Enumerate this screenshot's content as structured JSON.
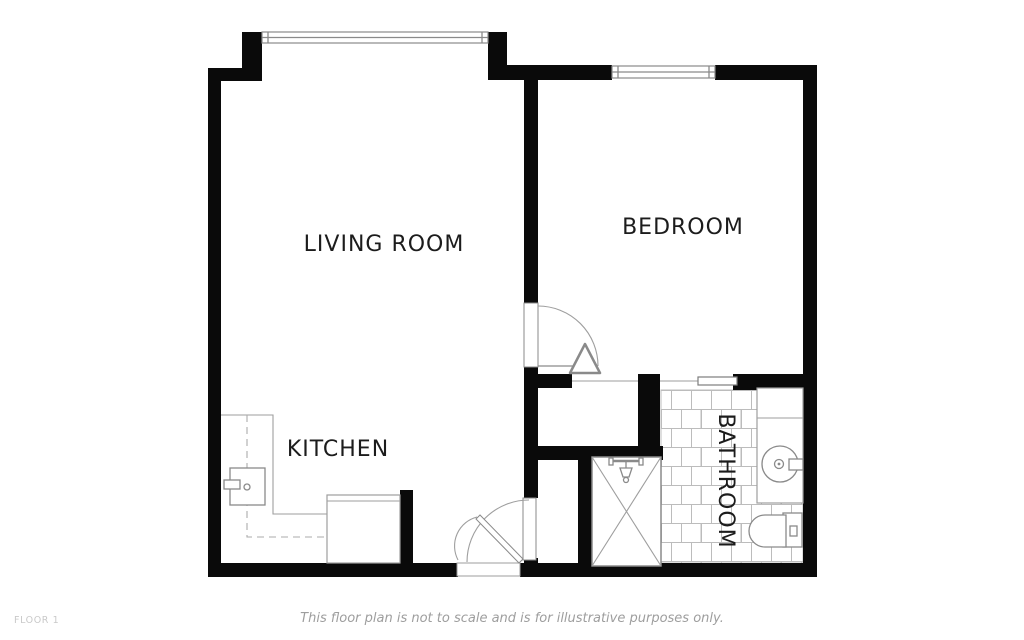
{
  "floor_plan": {
    "rooms": [
      {
        "name": "LIVING ROOM"
      },
      {
        "name": "BEDROOM"
      },
      {
        "name": "KITCHEN"
      },
      {
        "name": "BATHROOM"
      }
    ],
    "floor_label": "FLOOR 1",
    "disclaimer": "This floor plan is not to scale and is for illustrative purposes only.",
    "fixtures": {
      "windows": [
        "living-room-bay-window",
        "bedroom-window"
      ],
      "doors": [
        "bedroom-swing-door",
        "closet-bifold-door",
        "bathroom-sliding-door",
        "entry-swing-door",
        "storage-door"
      ],
      "bathroom": [
        "shower",
        "shower-head",
        "vanity-sink",
        "toilet",
        "tile-floor"
      ],
      "kitchen": [
        "counter",
        "sink",
        "upper-cabinets-dashed",
        "peninsula-counter"
      ]
    },
    "colors": {
      "walls": "#0a0a0a",
      "fixture_lines": "#8a8a8a",
      "tile_lines": "#bcbcbc",
      "label_text": "#1c1c1c",
      "disclaimer_text": "#9e9e9e",
      "floor_label_text": "#c9c9c9",
      "background": "#ffffff"
    }
  }
}
